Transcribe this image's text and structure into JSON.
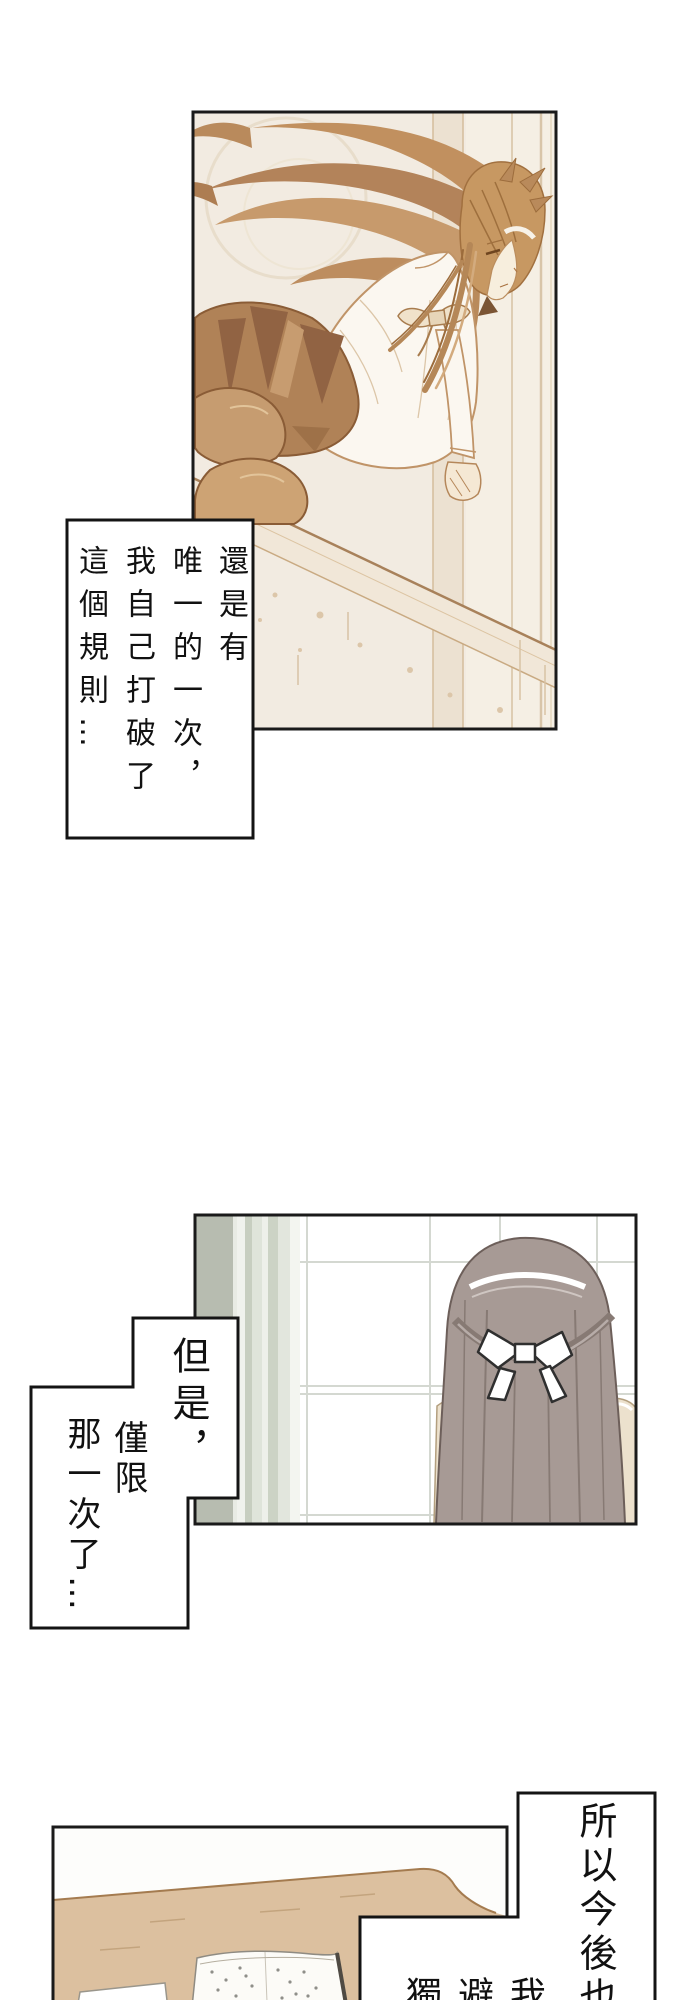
{
  "page": {
    "width": 690,
    "height": 2000,
    "background": "#ffffff",
    "content_type": "vertical manga comic page, Traditional Chinese, read right-to-left"
  },
  "palette": {
    "panel_border": "#1a1a1a",
    "bubble_border": "#141414",
    "bubble_fill": "#ffffff",
    "text_color": "#111111",
    "panel1_sepia_bg": "#f2ebe1",
    "panel1_hair_brown": "#c1905f",
    "panel1_skirt_brown": "#b08257",
    "panel1_line_brown": "#a8815a",
    "panel2_curtain_green": "#b7bcb0",
    "panel2_window_grid": "#d4d8d1",
    "panel2_hair_gray": "#a79a95",
    "panel2_bow_white": "#ffffff",
    "panel3_desk_wood": "#dcc09f"
  },
  "speech_boxes": [
    {
      "id": "speech-box-1",
      "columns": [
        "還是有",
        "唯一的一次，",
        "我自己打破了",
        "這個規則…"
      ]
    },
    {
      "id": "speech-box-2",
      "columns": [
        "但是，",
        "僅限",
        "那一次了…"
      ]
    },
    {
      "id": "speech-box-3",
      "columns": [
        "所以今後也"
      ]
    },
    {
      "id": "speech-box-4",
      "columns": [
        "我",
        "避",
        "獨"
      ]
    }
  ]
}
